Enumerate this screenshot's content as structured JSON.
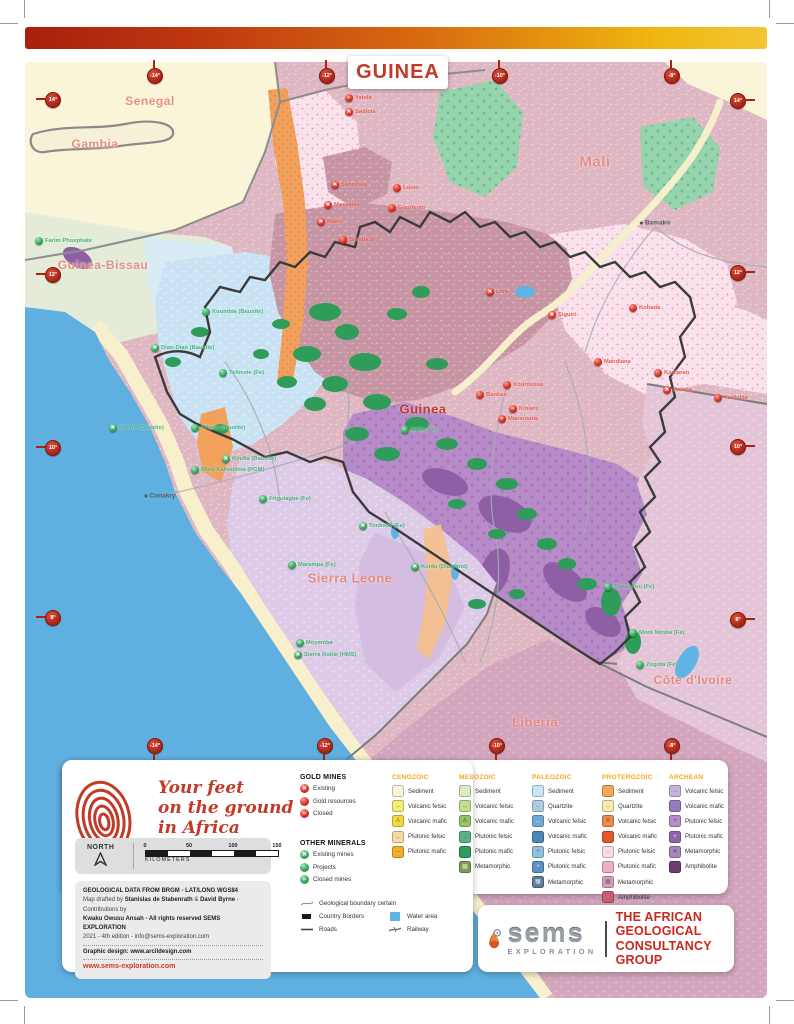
{
  "header": {
    "title": "GUINEA"
  },
  "colors": {
    "accent_red": "#c23a28",
    "header_gold": "#f6a81c",
    "gold_mine": "#d93025",
    "mineral_green": "#35a65c",
    "ocean": "#5fb0e0",
    "water_area": "#5fb4e5"
  },
  "map": {
    "countries": [
      {
        "name": "Senegal",
        "x": 125,
        "y": 39,
        "size": 12,
        "color": "#e59084"
      },
      {
        "name": "Gambia",
        "x": 70,
        "y": 82,
        "size": 12,
        "color": "#e59084"
      },
      {
        "name": "Guinea-Bissau",
        "x": 78,
        "y": 203,
        "size": 12,
        "color": "#e59084"
      },
      {
        "name": "Mali",
        "x": 570,
        "y": 100,
        "size": 15,
        "color": "#e59084"
      },
      {
        "name": "Guinea",
        "x": 398,
        "y": 347,
        "size": 13,
        "color": "#c23a28"
      },
      {
        "name": "Sierra Leone",
        "x": 325,
        "y": 516,
        "size": 13,
        "color": "#e8897d"
      },
      {
        "name": "Liberia",
        "x": 510,
        "y": 660,
        "size": 13,
        "color": "#e8897d"
      },
      {
        "name": "Côte d'Ivoire",
        "x": 668,
        "y": 618,
        "size": 12,
        "color": "#e8897d"
      }
    ],
    "cities": [
      {
        "name": "Bamako",
        "x": 630,
        "y": 161
      },
      {
        "name": "Conakry",
        "x": 135,
        "y": 434
      }
    ],
    "coords": {
      "top": [
        {
          "label": "-14°",
          "x": 130,
          "y": 14
        },
        {
          "label": "-12°",
          "x": 302,
          "y": 14
        },
        {
          "label": "-10°",
          "x": 475,
          "y": 14
        },
        {
          "label": "-8°",
          "x": 647,
          "y": 14
        }
      ],
      "bottom": [
        {
          "label": "-14°",
          "x": 130,
          "y": 684
        },
        {
          "label": "-12°",
          "x": 300,
          "y": 684
        },
        {
          "label": "-10°",
          "x": 472,
          "y": 684
        },
        {
          "label": "-8°",
          "x": 647,
          "y": 684
        }
      ],
      "left": [
        {
          "label": "14°",
          "x": 28,
          "y": 38
        },
        {
          "label": "12°",
          "x": 28,
          "y": 213
        },
        {
          "label": "10°",
          "x": 28,
          "y": 386
        },
        {
          "label": "8°",
          "x": 28,
          "y": 556
        }
      ],
      "right": [
        {
          "label": "14°",
          "x": 713,
          "y": 39
        },
        {
          "label": "12°",
          "x": 713,
          "y": 211
        },
        {
          "label": "10°",
          "x": 713,
          "y": 385
        },
        {
          "label": "8°",
          "x": 713,
          "y": 558
        }
      ]
    },
    "mines": [
      {
        "name": "Yatela",
        "type": "gold-closed",
        "x": 324,
        "y": 36
      },
      {
        "name": "Sadiola",
        "type": "gold-existing",
        "x": 324,
        "y": 50
      },
      {
        "name": "Sabodala",
        "type": "gold-existing",
        "x": 310,
        "y": 123
      },
      {
        "name": "Massawa",
        "type": "gold-existing",
        "x": 303,
        "y": 143
      },
      {
        "name": "Mako",
        "type": "gold-existing",
        "x": 296,
        "y": 160
      },
      {
        "name": "Loulo",
        "type": "gold-resource",
        "x": 372,
        "y": 126
      },
      {
        "name": "Gounkoto",
        "type": "gold-resource",
        "x": 367,
        "y": 146
      },
      {
        "name": "Bambadji",
        "type": "gold-resource",
        "x": 318,
        "y": 178
      },
      {
        "name": "Kobada",
        "type": "gold-resource",
        "x": 608,
        "y": 246
      },
      {
        "name": "Lefa",
        "type": "gold-existing",
        "x": 465,
        "y": 230
      },
      {
        "name": "Siguiri",
        "type": "gold-existing",
        "x": 527,
        "y": 253
      },
      {
        "name": "Kalana",
        "type": "gold-existing",
        "x": 642,
        "y": 328
      },
      {
        "name": "Bankan",
        "type": "gold-resource",
        "x": 455,
        "y": 333
      },
      {
        "name": "Kouroussa",
        "type": "gold-resource",
        "x": 482,
        "y": 323
      },
      {
        "name": "Kiniero",
        "type": "gold-closed",
        "x": 488,
        "y": 347
      },
      {
        "name": "Mansounia",
        "type": "gold-closed",
        "x": 477,
        "y": 357
      },
      {
        "name": "Mandiana",
        "type": "gold-resource",
        "x": 573,
        "y": 300
      },
      {
        "name": "Kodiaran",
        "type": "gold-resource",
        "x": 633,
        "y": 311
      },
      {
        "name": "Yanfolila",
        "type": "gold-resource",
        "x": 693,
        "y": 336
      },
      {
        "name": "Farim Phosphate",
        "type": "min-project",
        "x": 14,
        "y": 179
      },
      {
        "name": "Koumbia (Bauxite)",
        "type": "min-project",
        "x": 181,
        "y": 250
      },
      {
        "name": "Dian-Dian (Bauxite)",
        "type": "min-existing",
        "x": 130,
        "y": 286
      },
      {
        "name": "Telimele (Fe)",
        "type": "min-project",
        "x": 198,
        "y": 311
      },
      {
        "name": "Frigua (Bauxite)",
        "type": "min-project",
        "x": 170,
        "y": 366
      },
      {
        "name": "Bel Air (Bauxite)",
        "type": "min-existing",
        "x": 88,
        "y": 366
      },
      {
        "name": "Mont Kakoulima (PGM)",
        "type": "min-project",
        "x": 170,
        "y": 408
      },
      {
        "name": "Kindia (Bauxite)",
        "type": "min-existing",
        "x": 201,
        "y": 397
      },
      {
        "name": "Friguiagbe (Fe)",
        "type": "min-closed",
        "x": 238,
        "y": 437
      },
      {
        "name": "Kalia (Fe)",
        "type": "min-project",
        "x": 380,
        "y": 368
      },
      {
        "name": "Tonkolili (Fe)",
        "type": "min-existing",
        "x": 338,
        "y": 464
      },
      {
        "name": "Koidu (Diamond)",
        "type": "min-existing",
        "x": 390,
        "y": 505
      },
      {
        "name": "Marampa (Fe)",
        "type": "min-project",
        "x": 267,
        "y": 503
      },
      {
        "name": "Sierra Rutile (HMS)",
        "type": "min-existing",
        "x": 273,
        "y": 593
      },
      {
        "name": "Moyamba",
        "type": "min-closed",
        "x": 275,
        "y": 581
      },
      {
        "name": "Simandou (Fe)",
        "type": "min-project",
        "x": 583,
        "y": 525
      },
      {
        "name": "Mont Nimba (Fe)",
        "type": "min-project",
        "x": 608,
        "y": 571
      },
      {
        "name": "Zogota (Fe)",
        "type": "min-project",
        "x": 615,
        "y": 603
      }
    ]
  },
  "branding": {
    "tagline_line1": "Your feet",
    "tagline_line2": "on the ground",
    "tagline_line3": "in Africa"
  },
  "scalebar": {
    "north_label": "NORTH",
    "ticks": [
      "0",
      "50",
      "100",
      "150"
    ],
    "unit": "KILOMETERS"
  },
  "credits": {
    "line1": "GEOLOGICAL DATA FROM BRGM - LAT/LONG WGS84",
    "line2_prefix": "Map drafted by ",
    "line2_bold1": "Stanislas de Stabenrath",
    "line2_mid": " & ",
    "line2_bold2": "David Byrne",
    "line2_suffix": " -  Contributions by",
    "line3": "Kwaku Owusu Ansah - All rights reserved SEMS EXPLORATION",
    "line4": "2021  -  4th edition - info@sems-exploration.com",
    "line5_label": "Graphic design: ",
    "line5_value": "www.arcildesign.com",
    "website": "www.sems-exploration.com"
  },
  "mines_legend": {
    "gold": {
      "title": "GOLD MINES",
      "items": [
        {
          "label": "Existing",
          "glyph": "x"
        },
        {
          "label": "Gold resources",
          "glyph": ""
        },
        {
          "label": "Closed",
          "glyph": "-"
        }
      ]
    },
    "other": {
      "title": "OTHER MINERALS",
      "items": [
        {
          "label": "Existing mines",
          "glyph": "x"
        },
        {
          "label": "Projects",
          "glyph": ""
        },
        {
          "label": "Closed mines",
          "glyph": "-"
        }
      ]
    }
  },
  "era_legend": [
    {
      "name": "CENOZOIC",
      "left": 330,
      "items": [
        {
          "label": "Sediment",
          "color": "#fbf5d8",
          "glyph": ""
        },
        {
          "label": "Volcanic felsic",
          "color": "#f7ec7a",
          "glyph": "dots"
        },
        {
          "label": "Volcanic mafic",
          "color": "#f3d83f",
          "glyph": "A"
        },
        {
          "label": "Plutonic felsic",
          "color": "#f8d9a2",
          "glyph": "dots"
        },
        {
          "label": "Plutonic mafic",
          "color": "#f3ae2c",
          "glyph": "-"
        }
      ]
    },
    {
      "name": "MESOZOIC",
      "left": 397,
      "items": [
        {
          "label": "Sediment",
          "color": "#ddebc4",
          "glyph": ""
        },
        {
          "label": "Volcanic felsic",
          "color": "#bfdf92",
          "glyph": "dots"
        },
        {
          "label": "Volcanic mafic",
          "color": "#94c36a",
          "glyph": "A"
        },
        {
          "label": "Plutonic felsic",
          "color": "#57b287",
          "glyph": "dots"
        },
        {
          "label": "Plutonic mafic",
          "color": "#2e9c5f",
          "glyph": ""
        },
        {
          "label": "Metamorphic",
          "color": "#7e9c52",
          "glyph": "grid",
          "glyph_color": "#ffffffcc"
        }
      ]
    },
    {
      "name": "PALEOZOIC",
      "left": 470,
      "items": [
        {
          "label": "Sediment",
          "color": "#c9e6f7",
          "glyph": ""
        },
        {
          "label": "Quartzite",
          "color": "#aecde0",
          "glyph": "dots"
        },
        {
          "label": "Volcanic felsic",
          "color": "#74a8d4",
          "glyph": "dots",
          "glyph_color": "#ffffffcc"
        },
        {
          "label": "Volcanic mafic",
          "color": "#4e87b9",
          "glyph": ""
        },
        {
          "label": "Plutonic felsic",
          "color": "#90bfe0",
          "glyph": "+"
        },
        {
          "label": "Plutonic mafic",
          "color": "#5c91c2",
          "glyph": "+",
          "glyph_color": "#ffffffcc"
        },
        {
          "label": "Metamorphic",
          "color": "#5e7e9b",
          "glyph": "grid",
          "glyph_color": "#ffffffcc"
        }
      ]
    },
    {
      "name": "PROTEROZOIC",
      "left": 540,
      "items": [
        {
          "label": "Sediment",
          "color": "#f5a75a",
          "glyph": ""
        },
        {
          "label": "Quartzite",
          "color": "#f6ebb2",
          "glyph": "dots"
        },
        {
          "label": "Volcanic felsic",
          "color": "#ed8a4d",
          "glyph": "x"
        },
        {
          "label": "Volcanic mafic",
          "color": "#e1562e",
          "glyph": ""
        },
        {
          "label": "Plutonic felsic",
          "color": "#fadce8",
          "glyph": "dots"
        },
        {
          "label": "Plutonic mafic",
          "color": "#f3adca",
          "glyph": ""
        },
        {
          "label": "Metamorphic",
          "color": "#d79fb4",
          "glyph": "grid"
        },
        {
          "label": "Amphibolite",
          "color": "#c75f74",
          "glyph": ""
        }
      ]
    },
    {
      "name": "ARCHEAN",
      "left": 607,
      "items": [
        {
          "label": "Volcanic felsic",
          "color": "#c7b2da",
          "glyph": "dots"
        },
        {
          "label": "Volcanic mafic",
          "color": "#9779bd",
          "glyph": ""
        },
        {
          "label": "Plutonic felsic",
          "color": "#b58dc9",
          "glyph": "+"
        },
        {
          "label": "Plutonic mafic",
          "color": "#8f64ad",
          "glyph": "+",
          "glyph_color": "#ffffffcc"
        },
        {
          "label": "Metamorphic",
          "color": "#a887c1",
          "glyph": "x"
        },
        {
          "label": "Amphibolite",
          "color": "#6d3d72",
          "glyph": ""
        }
      ]
    }
  ],
  "symbols_legend": [
    {
      "icon": "boundary",
      "label": "Geological boundary certain",
      "col": 0,
      "row": 0
    },
    {
      "icon": "border",
      "label": "Country Borders",
      "col": 0,
      "row": 1
    },
    {
      "icon": "road",
      "label": "Roads",
      "col": 0,
      "row": 2
    },
    {
      "icon": "water",
      "label": "Water area",
      "col": 1,
      "row": 1
    },
    {
      "icon": "railway",
      "label": "Railway",
      "col": 1,
      "row": 2
    }
  ],
  "sems": {
    "brand": "sems",
    "sub": "EXPLORATION",
    "tagline_line1": "THE AFRICAN GEOLOGICAL",
    "tagline_line2": "CONSULTANCY GROUP"
  }
}
